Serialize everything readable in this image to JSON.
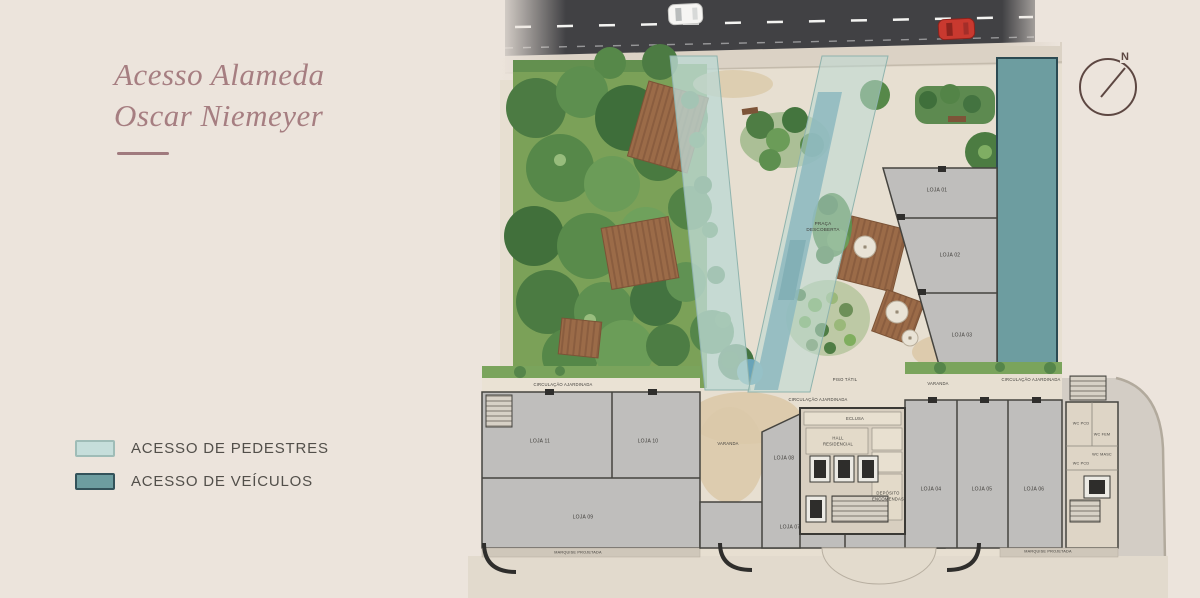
{
  "header": {
    "title_line1": "Acesso Alameda",
    "title_line2": "Oscar Niemeyer"
  },
  "legend": {
    "items": [
      {
        "label": "ACESSO DE PEDESTRES",
        "swatch": "#c6dedb",
        "swatch_border": "#9fbcb7"
      },
      {
        "label": "ACESSO DE VEÍCULOS",
        "swatch": "#6d9da0",
        "swatch_border": "#33525a"
      }
    ]
  },
  "compass": {
    "north_label": "N"
  },
  "road": {
    "cars": [
      {
        "name": "white-car",
        "color": "#f6f5f3"
      },
      {
        "name": "red-car",
        "color": "#c9392f"
      }
    ]
  },
  "colors": {
    "page_bg": "#ece4dc",
    "title": "#a67e81",
    "road": "#414144",
    "pedestrian": "#bcd8d3",
    "vehicle": "#6d9da0",
    "lawn": "#7ba158",
    "concrete": "#bfbebc",
    "wall": "#45443f",
    "water": "#5693a7",
    "sand": "#dbc9a9",
    "deck_wood": "#9b6b48"
  },
  "plan": {
    "labels": [
      {
        "text": "PRAÇA\nDESCOBERTA",
        "x": 823,
        "y": 227,
        "size": 4.6
      },
      {
        "text": "PISO TÁTIL",
        "x": 845,
        "y": 380,
        "size": 4.2
      },
      {
        "text": "CIRCULAÇÃO AJARDINADA",
        "x": 563,
        "y": 385,
        "size": 4.2
      },
      {
        "text": "CIRCULAÇÃO AJARDINADA",
        "x": 818,
        "y": 400,
        "size": 4.2
      },
      {
        "text": "CIRCULAÇÃO AJARDINADA",
        "x": 1031,
        "y": 380,
        "size": 4.2
      },
      {
        "text": "VARANDA",
        "x": 938,
        "y": 384,
        "size": 4.2
      },
      {
        "text": "VARANDA",
        "x": 728,
        "y": 444,
        "size": 4.2
      },
      {
        "text": "LOJA 01",
        "x": 937,
        "y": 191,
        "size": 5
      },
      {
        "text": "LOJA 02",
        "x": 950,
        "y": 256,
        "size": 5
      },
      {
        "text": "LOJA 03",
        "x": 962,
        "y": 336,
        "size": 5
      },
      {
        "text": "LOJA 04",
        "x": 931,
        "y": 490,
        "size": 5
      },
      {
        "text": "LOJA 05",
        "x": 982,
        "y": 490,
        "size": 5
      },
      {
        "text": "LOJA 06",
        "x": 1034,
        "y": 490,
        "size": 5
      },
      {
        "text": "LOJA 07",
        "x": 790,
        "y": 528,
        "size": 5
      },
      {
        "text": "LOJA 08",
        "x": 784,
        "y": 459,
        "size": 5
      },
      {
        "text": "LOJA 09",
        "x": 583,
        "y": 518,
        "size": 5
      },
      {
        "text": "LOJA 10",
        "x": 648,
        "y": 442,
        "size": 5
      },
      {
        "text": "LOJA 11",
        "x": 540,
        "y": 442,
        "size": 5
      },
      {
        "text": "ECLUSA",
        "x": 855,
        "y": 419,
        "size": 4.2
      },
      {
        "text": "HALL\nRESIDENCIAL",
        "x": 838,
        "y": 441,
        "size": 4.2
      },
      {
        "text": "DEPÓSITO\nENCOMENDAS",
        "x": 888,
        "y": 496,
        "size": 4.2
      },
      {
        "text": "WC PCD",
        "x": 1081,
        "y": 424,
        "size": 3.8
      },
      {
        "text": "WC FEM",
        "x": 1102,
        "y": 435,
        "size": 3.8
      },
      {
        "text": "WC MASC",
        "x": 1102,
        "y": 455,
        "size": 3.8
      },
      {
        "text": "WC PCD",
        "x": 1081,
        "y": 464,
        "size": 3.8
      },
      {
        "text": "MARQUISE PROJETADA",
        "x": 578,
        "y": 553,
        "size": 3.8
      },
      {
        "text": "MARQUISE PROJETADA",
        "x": 1048,
        "y": 552,
        "size": 3.8
      }
    ]
  }
}
